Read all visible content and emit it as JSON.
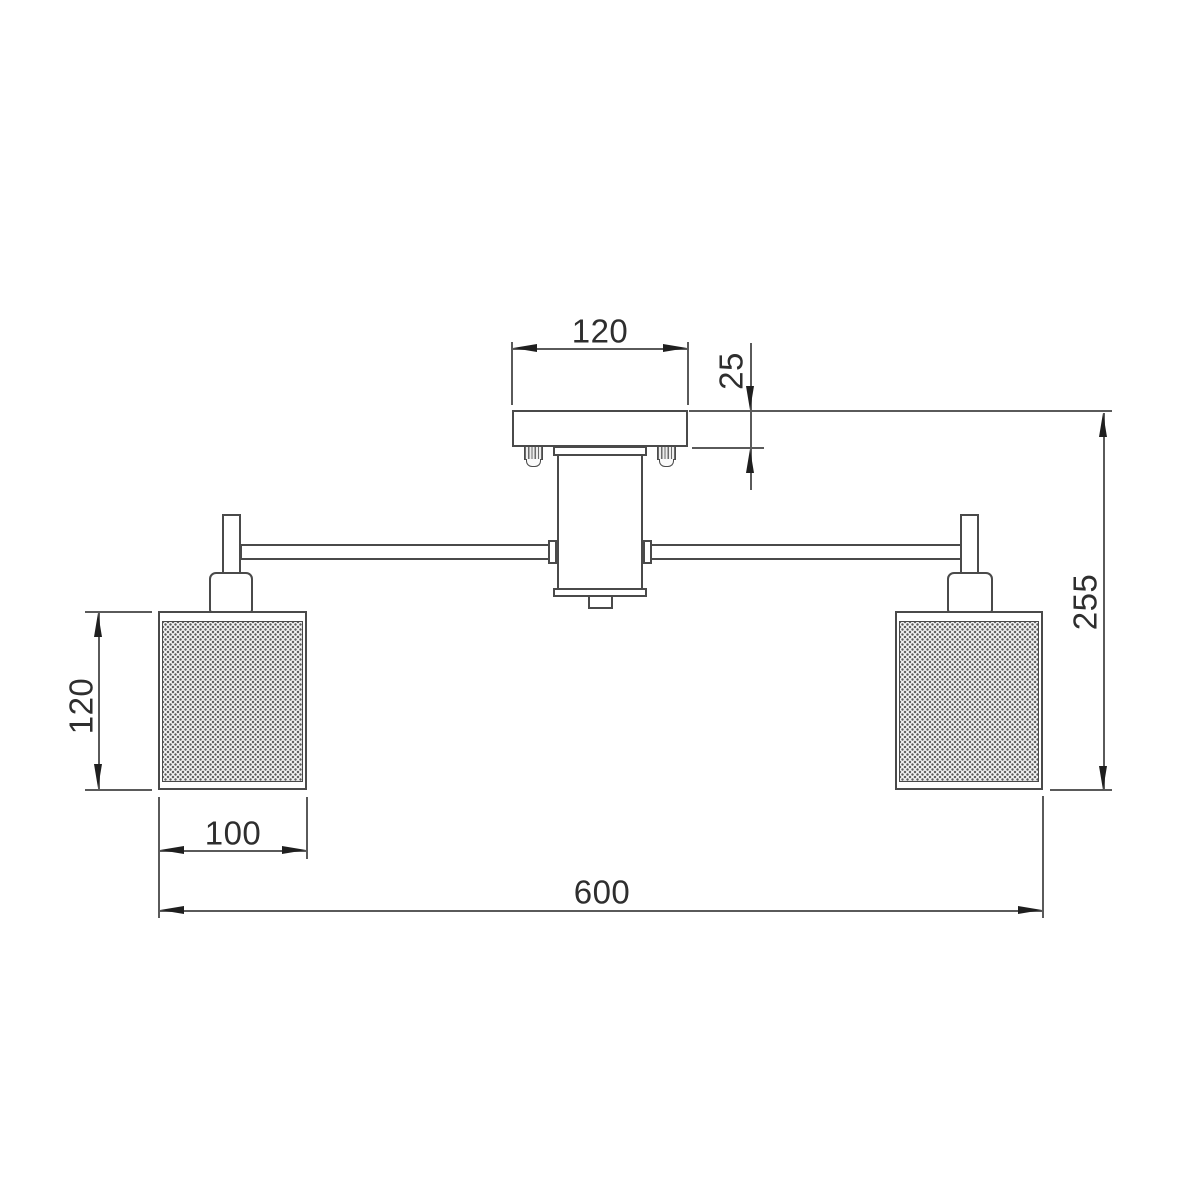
{
  "drawing": {
    "kind": "ceiling-light-fixture-dimension-drawing",
    "labels": {
      "canopy_width": "120",
      "canopy_height": "25",
      "overall_height": "255",
      "shade_height": "120",
      "shade_width": "100",
      "overall_width": "600"
    },
    "colors": {
      "line": "#4a4a4a",
      "dimension_line": "#5a5a5a",
      "arrow": "#1f1f1f",
      "text": "#2e2e2e",
      "background": "#ffffff"
    }
  }
}
